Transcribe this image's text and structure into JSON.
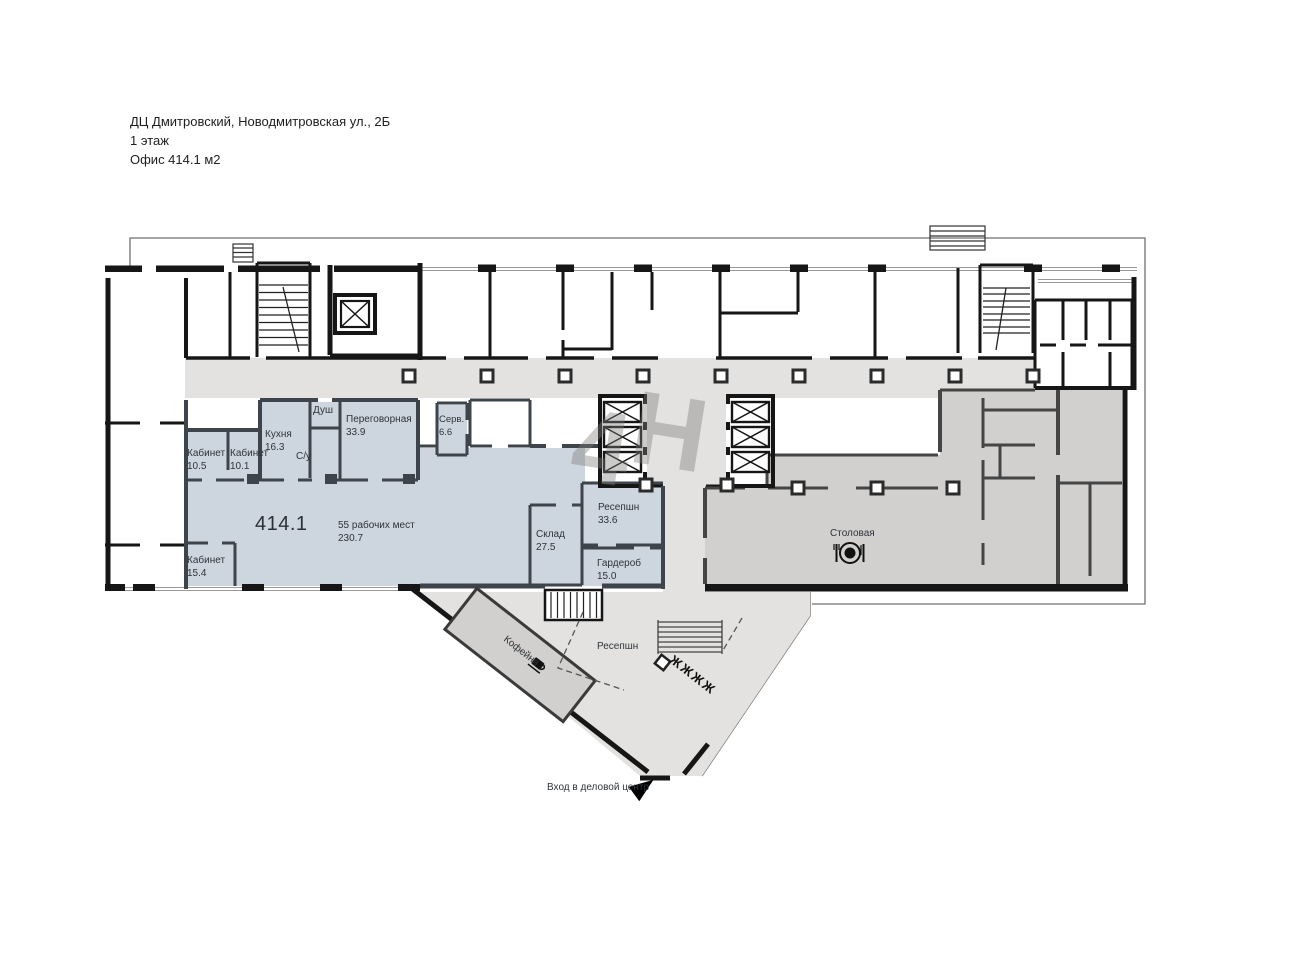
{
  "title": {
    "line1": "ДЦ Дмитровский, Новодмитровская ул., 2Б",
    "line2": "1 этаж",
    "line3": "Офис 414.1 м2"
  },
  "watermark": {
    "char1": "4",
    "char2": "Н"
  },
  "office": {
    "area_label": "414.1",
    "workplaces": "55 рабочих мест",
    "workplaces_area": "230.7"
  },
  "rooms": {
    "kabinet_105": {
      "name": "Кабинет",
      "area": "10.5"
    },
    "kabinet_101": {
      "name": "Кабинет",
      "area": "10.1"
    },
    "kuhnya": {
      "name": "Кухня",
      "area": "16.3"
    },
    "dush": {
      "name": "Душ"
    },
    "su": {
      "name": "С/у"
    },
    "peregovornaya": {
      "name": "Переговорная",
      "area": "33.9"
    },
    "serv": {
      "name": "Серв.",
      "area": "6.6"
    },
    "kabinet_154": {
      "name": "Кабинет",
      "area": "15.4"
    },
    "sklad": {
      "name": "Склад",
      "area": "27.5"
    },
    "resepshn_office": {
      "name": "Ресепшн",
      "area": "33.6"
    },
    "garderob": {
      "name": "Гардероб",
      "area": "15.0"
    },
    "stolovaya": {
      "name": "Столовая"
    },
    "kofeynya": {
      "name": "Кофейня"
    },
    "resepshn_lobby": {
      "name": "Ресепшн"
    }
  },
  "entrance": {
    "label": "Вход в деловой центр"
  },
  "icons": {
    "turnstile_glyphs": "ЖЖЖЖ"
  },
  "colors": {
    "office_fill": "#cdd5de",
    "common_fill": "#e3e2e0",
    "service_fill": "#d1d0ce",
    "outer_wall": "#161616",
    "office_wall": "#3e444b",
    "service_wall": "#454545"
  }
}
